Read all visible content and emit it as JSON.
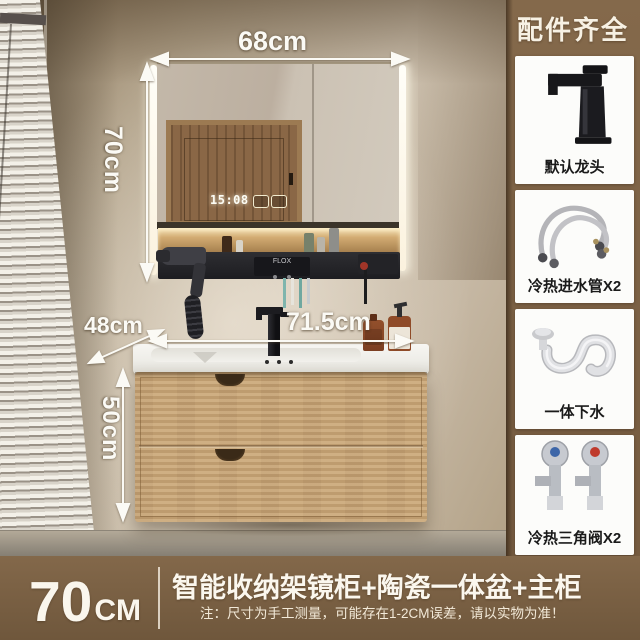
{
  "measurements": {
    "mirror_width": "68cm",
    "mirror_height": "70cm",
    "counter_depth": "48cm",
    "counter_width": "71.5cm",
    "cabinet_height": "50cm"
  },
  "scene": {
    "clock_time": "15:08",
    "rack_brand": "FLOX"
  },
  "sidebar": {
    "title": "配件齐全",
    "items": [
      {
        "id": "default-faucet",
        "label": "默认龙头"
      },
      {
        "id": "inlet-hoses",
        "label": "冷热进水管X2"
      },
      {
        "id": "integrated-drain",
        "label": "一体下水"
      },
      {
        "id": "angle-valves",
        "label": "冷热三角阀X2"
      }
    ]
  },
  "footer": {
    "size_number": "70",
    "size_unit": "CM",
    "title": "智能收纳架镜柜+陶瓷一体盆+主柜",
    "note": "注：尺寸为手工测量，可能存在1-2CM误差，请以实物为准！"
  },
  "colors": {
    "panel_brown": "#7c6347",
    "card_white": "#fcfcfa",
    "cabinet_wood": "#c8a679",
    "counter_white": "#f4f3ef",
    "label_ink": "#1a1a1a",
    "measure_text": "#fbfaf5"
  }
}
